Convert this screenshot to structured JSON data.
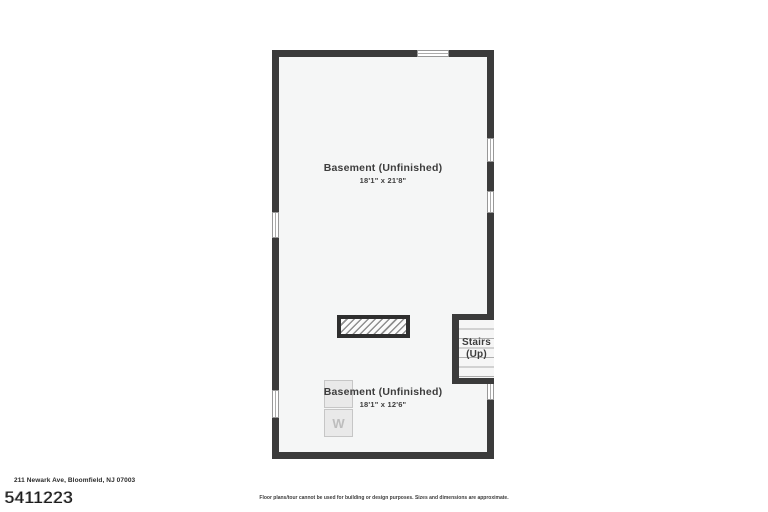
{
  "floorplan": {
    "rooms": [
      {
        "name": "Basement (Unfinished)",
        "dimensions": "18'1\" x 21'8\""
      },
      {
        "name": "Basement (Unfinished)",
        "dimensions": "18'1\" x 12'6\""
      }
    ],
    "stairs": {
      "line1": "Stairs",
      "line2": "(Up)"
    },
    "appliances": [
      {
        "label": ""
      },
      {
        "label": "W"
      }
    ]
  },
  "footer": {
    "address": "211 Newark Ave, Bloomfield, NJ 07003",
    "mls_number": "5411223",
    "disclaimer": "Floor plans/tour cannot be used for building or design purposes. Sizes and dimensions are approximate."
  },
  "colors": {
    "wall": "#3b3b3b",
    "floor_fill": "#f5f6f6",
    "label_text": "#3d3d3d",
    "appliance_fill": "#e9e9e9",
    "appliance_text": "#bdbdbd"
  }
}
